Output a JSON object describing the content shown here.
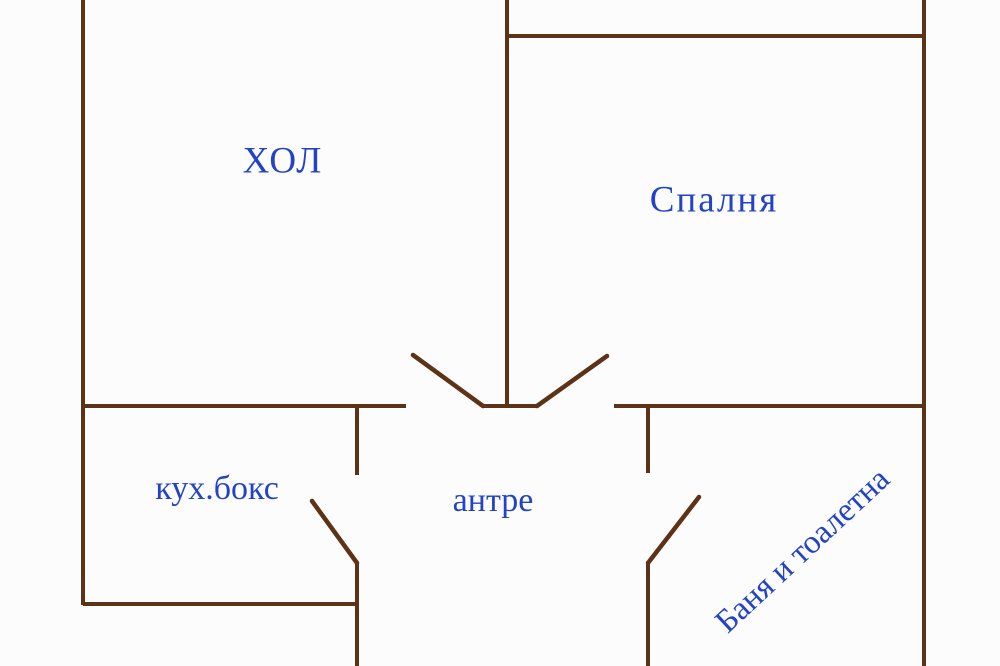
{
  "plan_title": "apartment floor plan",
  "rooms": {
    "hall": {
      "label": "ХОЛ"
    },
    "bedroom": {
      "label": "Спалня"
    },
    "kitchen": {
      "label": "кух.бокс"
    },
    "entry": {
      "label": "антре"
    },
    "bathroom": {
      "label": "Баня и тоалетна"
    }
  },
  "colors": {
    "wall": "#5d3318",
    "label": "#2342c6",
    "background": "#fcfcfc"
  }
}
